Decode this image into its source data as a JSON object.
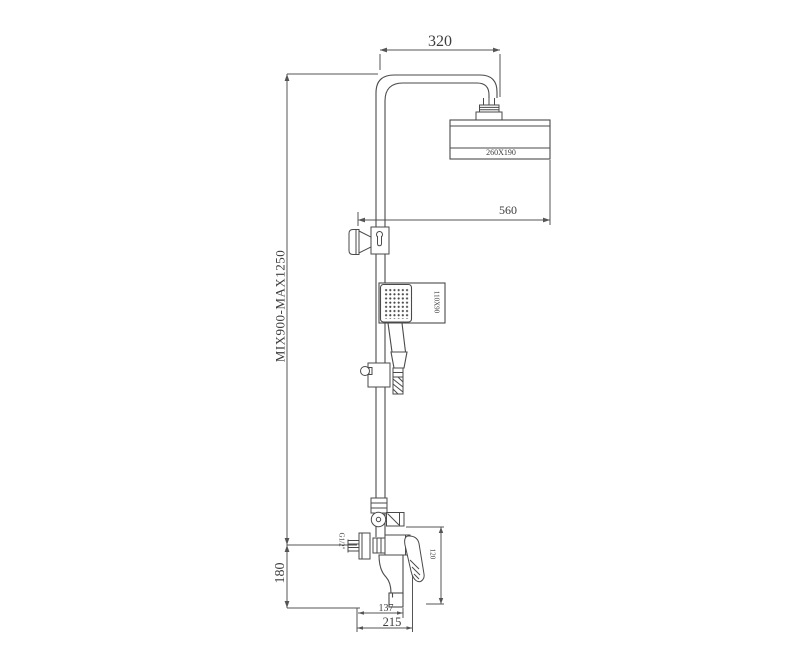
{
  "figure": {
    "type": "technical-drawing",
    "subject": "shower column set with overhead shower, hand shower and mixer tap",
    "background": "#ffffff",
    "line_color": "#4a4a4a",
    "text_color": "#3d3d3d"
  },
  "dimensions": {
    "top_arm_width": "320",
    "head_to_wall": "560",
    "shower_head_size": "260X190",
    "hand_shower_size": "110X90",
    "column_height_range": "MIX900-MAX1250",
    "mixer_height": "180",
    "inlet_thread": "G1/2\"",
    "handle_drop": "120",
    "spout_reach": "137",
    "total_reach": "215"
  }
}
